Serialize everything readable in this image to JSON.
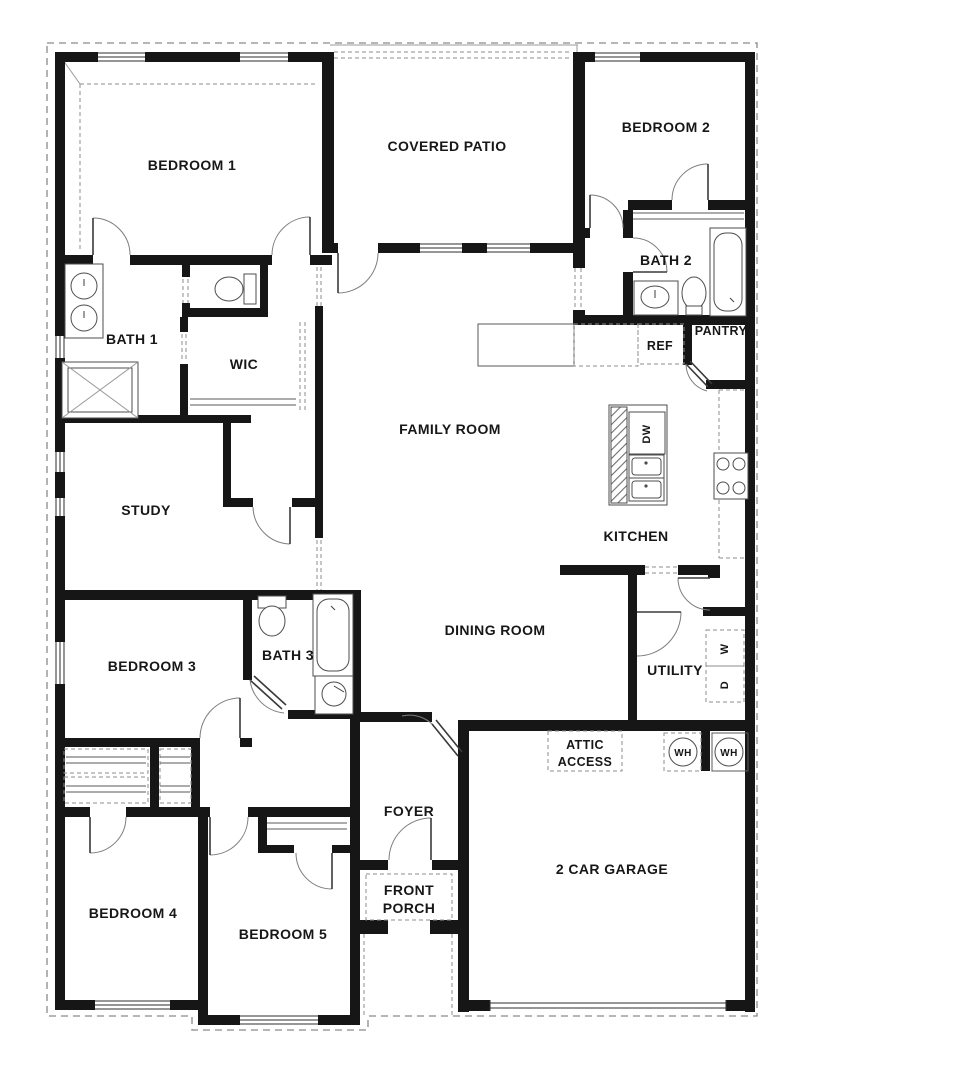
{
  "plan": {
    "type": "single-story house floor plan",
    "colors": {
      "wall": "#161616",
      "line": "#3e3e3e",
      "dashed": "#8e8e8e",
      "background": "#ffffff",
      "text": "#171717"
    },
    "rooms": {
      "bedroom1": {
        "label": "BEDROOM 1"
      },
      "covered_patio": {
        "label": "COVERED PATIO"
      },
      "bedroom2": {
        "label": "BEDROOM 2"
      },
      "bath2": {
        "label": "BATH 2"
      },
      "pantry": {
        "label": "PANTRY"
      },
      "ref": {
        "label": "REF"
      },
      "bath1": {
        "label": "BATH 1"
      },
      "wic": {
        "label": "WIC"
      },
      "family_room": {
        "label": "FAMILY ROOM"
      },
      "study": {
        "label": "STUDY"
      },
      "kitchen": {
        "label": "KITCHEN"
      },
      "dishwasher": {
        "label": "DW"
      },
      "dining_room": {
        "label": "DINING ROOM"
      },
      "bedroom3": {
        "label": "BEDROOM 3"
      },
      "bath3": {
        "label": "BATH 3"
      },
      "utility": {
        "label": "UTILITY"
      },
      "washer": {
        "label": "W"
      },
      "dryer": {
        "label": "D"
      },
      "water_heater_1": {
        "label": "WH"
      },
      "water_heater_2": {
        "label": "WH"
      },
      "attic_access_line1": {
        "label": "ATTIC"
      },
      "attic_access_line2": {
        "label": "ACCESS"
      },
      "foyer": {
        "label": "FOYER"
      },
      "front_porch_line1": {
        "label": "FRONT"
      },
      "front_porch_line2": {
        "label": "PORCH"
      },
      "garage": {
        "label": "2 CAR GARAGE"
      },
      "bedroom4": {
        "label": "BEDROOM 4"
      },
      "bedroom5": {
        "label": "BEDROOM 5"
      }
    },
    "fixtures": [
      "double-vanity-sinks-bath1",
      "shower-bath1",
      "toilet-bath1",
      "vanity-sink-bath2",
      "toilet-bath2",
      "tub-bath2",
      "toilet-bath3",
      "tub-bath3",
      "sink-bath3",
      "kitchen-island-dishwasher",
      "kitchen-double-sink",
      "cooktop",
      "refrigerator-space",
      "washer-space",
      "dryer-space",
      "water-heater-left",
      "water-heater-right",
      "garage-door"
    ]
  }
}
